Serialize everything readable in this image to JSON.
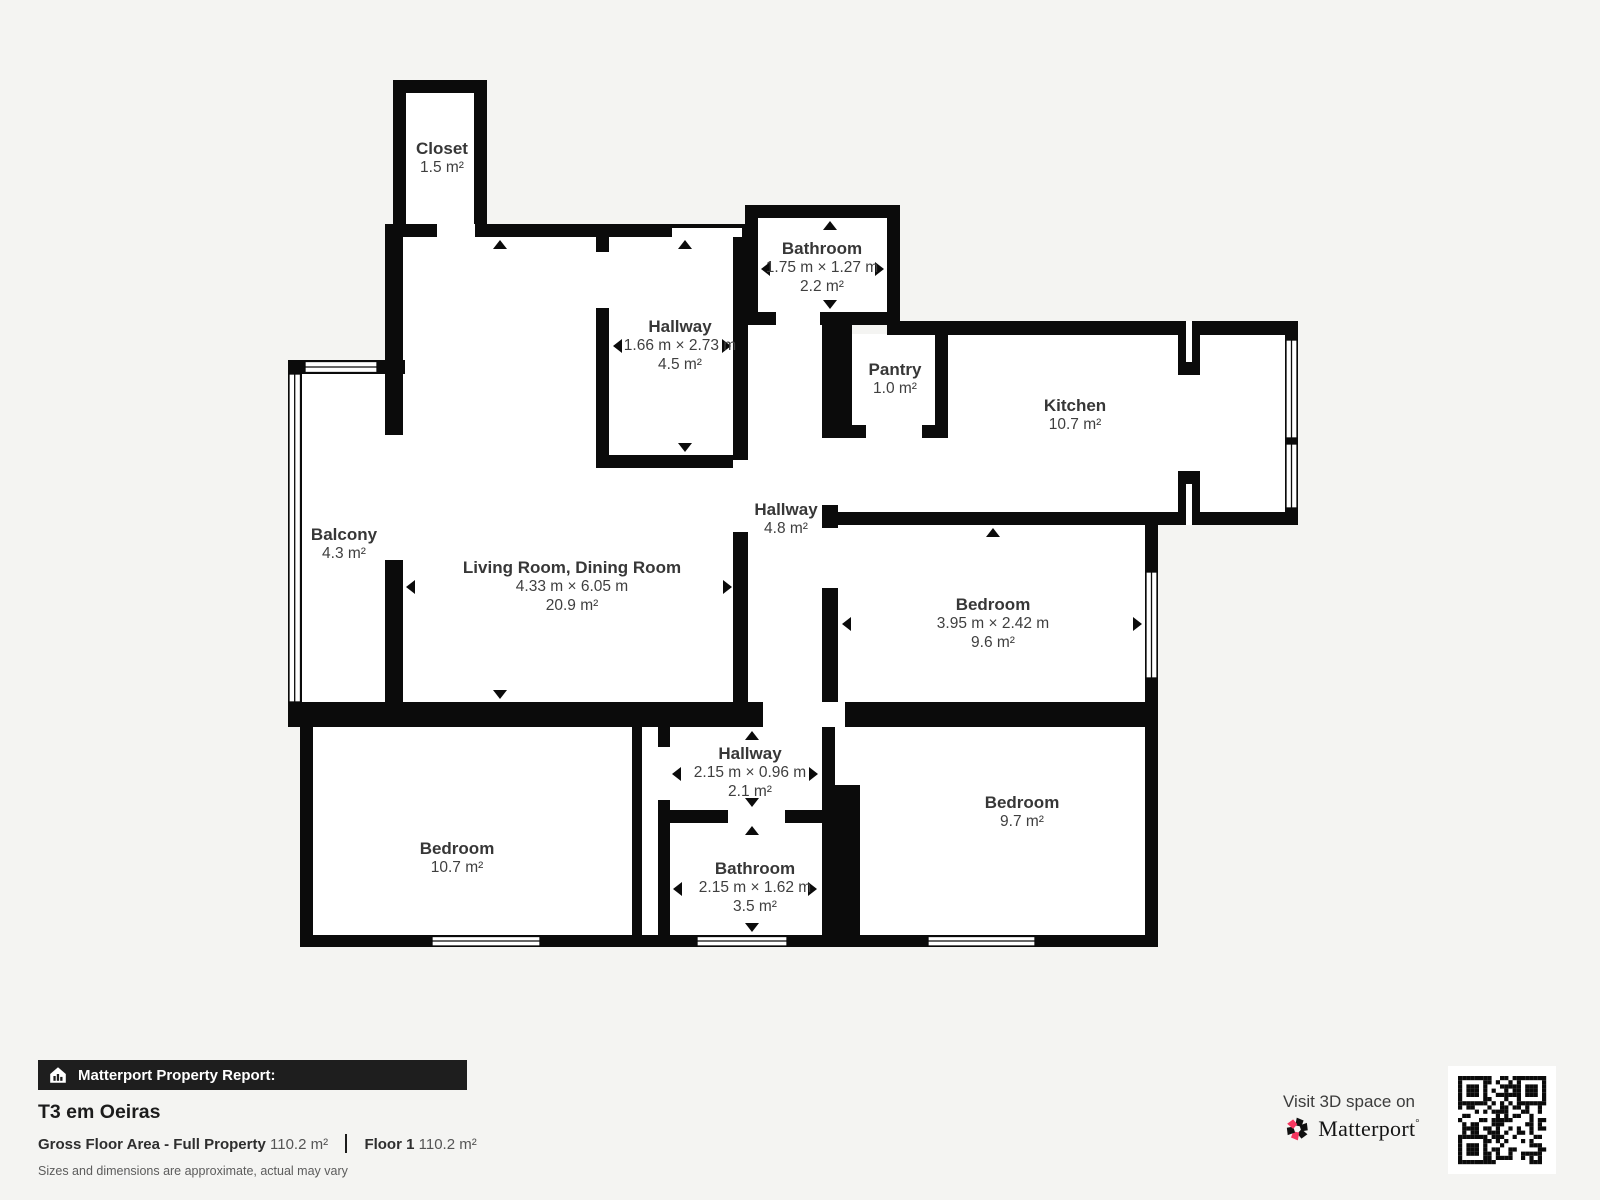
{
  "colors": {
    "background": "#f4f4f2",
    "wall": "#0b0b0b",
    "brand_pink": "#f4365f"
  },
  "rooms": {
    "closet": {
      "name": "Closet",
      "area": "1.5 m²"
    },
    "bathroom_top": {
      "name": "Bathroom",
      "dims": "1.75 m × 1.27 m",
      "area": "2.2 m²"
    },
    "hallway_top": {
      "name": "Hallway",
      "dims": "1.66 m × 2.73 m",
      "area": "4.5 m²"
    },
    "pantry": {
      "name": "Pantry",
      "area": "1.0 m²"
    },
    "kitchen": {
      "name": "Kitchen",
      "area": "10.7 m²"
    },
    "balcony": {
      "name": "Balcony",
      "area": "4.3 m²"
    },
    "living": {
      "name": "Living Room, Dining Room",
      "dims": "4.33 m × 6.05 m",
      "area": "20.9 m²"
    },
    "hallway_mid": {
      "name": "Hallway",
      "area": "4.8 m²"
    },
    "bedroom_right": {
      "name": "Bedroom",
      "dims": "3.95 m × 2.42 m",
      "area": "9.6 m²"
    },
    "hallway_bottom": {
      "name": "Hallway",
      "dims": "2.15 m × 0.96 m",
      "area": "2.1 m²"
    },
    "bedroom_left": {
      "name": "Bedroom",
      "area": "10.7 m²"
    },
    "bathroom_bottom": {
      "name": "Bathroom",
      "dims": "2.15 m × 1.62 m",
      "area": "3.5 m²"
    },
    "bedroom_bottom_right": {
      "name": "Bedroom",
      "area": "9.7 m²"
    }
  },
  "footer": {
    "report_label": "Matterport Property Report:",
    "property_title": "T3 em Oeiras",
    "gross_label": "Gross Floor Area - Full Property",
    "gross_value": "110.2 m²",
    "floor_label": "Floor 1",
    "floor_value": "110.2 m²",
    "disclaimer": "Sizes and dimensions are approximate, actual may vary",
    "visit_text": "Visit 3D space on",
    "brand": "Matterport",
    "brand_mark": "°"
  }
}
